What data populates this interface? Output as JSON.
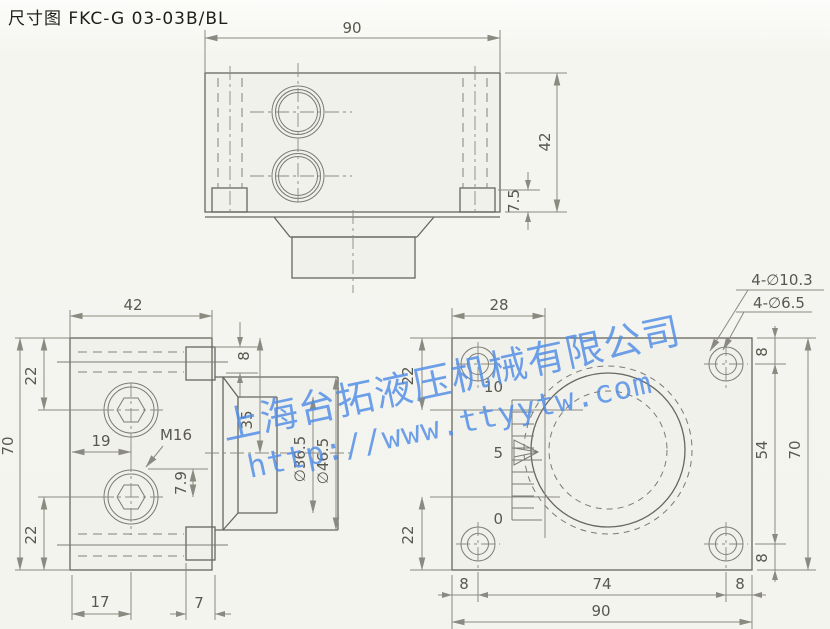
{
  "title": "尺寸图 FKC-G 03-03B/BL",
  "watermark": {
    "company": "上海台拓液压机械有限公司",
    "url": "http://www.ttyytw.com",
    "color": "#4f8de6"
  },
  "colors": {
    "outline": "#67675f",
    "dimension": "#8a8a81",
    "background": "#f4f4ef",
    "watermark_blue": "#4f8de6"
  },
  "top_view": {
    "width_label": "90",
    "height_label": "42",
    "foot_height_label": "7.5"
  },
  "side_view": {
    "width_label": "42",
    "height_label": "70",
    "top_port_offset_label": "22",
    "bottom_port_offset_label": "22",
    "port_center_label": "19",
    "thread_label": "M16",
    "step_label": "7.9",
    "bottom_left_label": "17",
    "bottom_right_label": "7",
    "boss_height_label": "8",
    "half_height_label": "35",
    "knob_inner_dia_label": "∅36.5",
    "knob_outer_dia_label": "∅46.5"
  },
  "front_view": {
    "scale_offset_label": "28",
    "hole_note_outer": "4-∅10.3",
    "hole_note_inner": "4-∅6.5",
    "top_left_offset_label": "22",
    "bottom_left_offset_label": "22",
    "scale_marks": {
      "top": "10",
      "mid": "5",
      "bottom": "0"
    },
    "right_top_label": "8",
    "hole_span_v_label": "54",
    "right_bottom_label": "8",
    "total_height_label": "70",
    "bottom_left_label": "8",
    "hole_span_h_label": "74",
    "bottom_right_label": "8",
    "total_width_label": "90"
  }
}
